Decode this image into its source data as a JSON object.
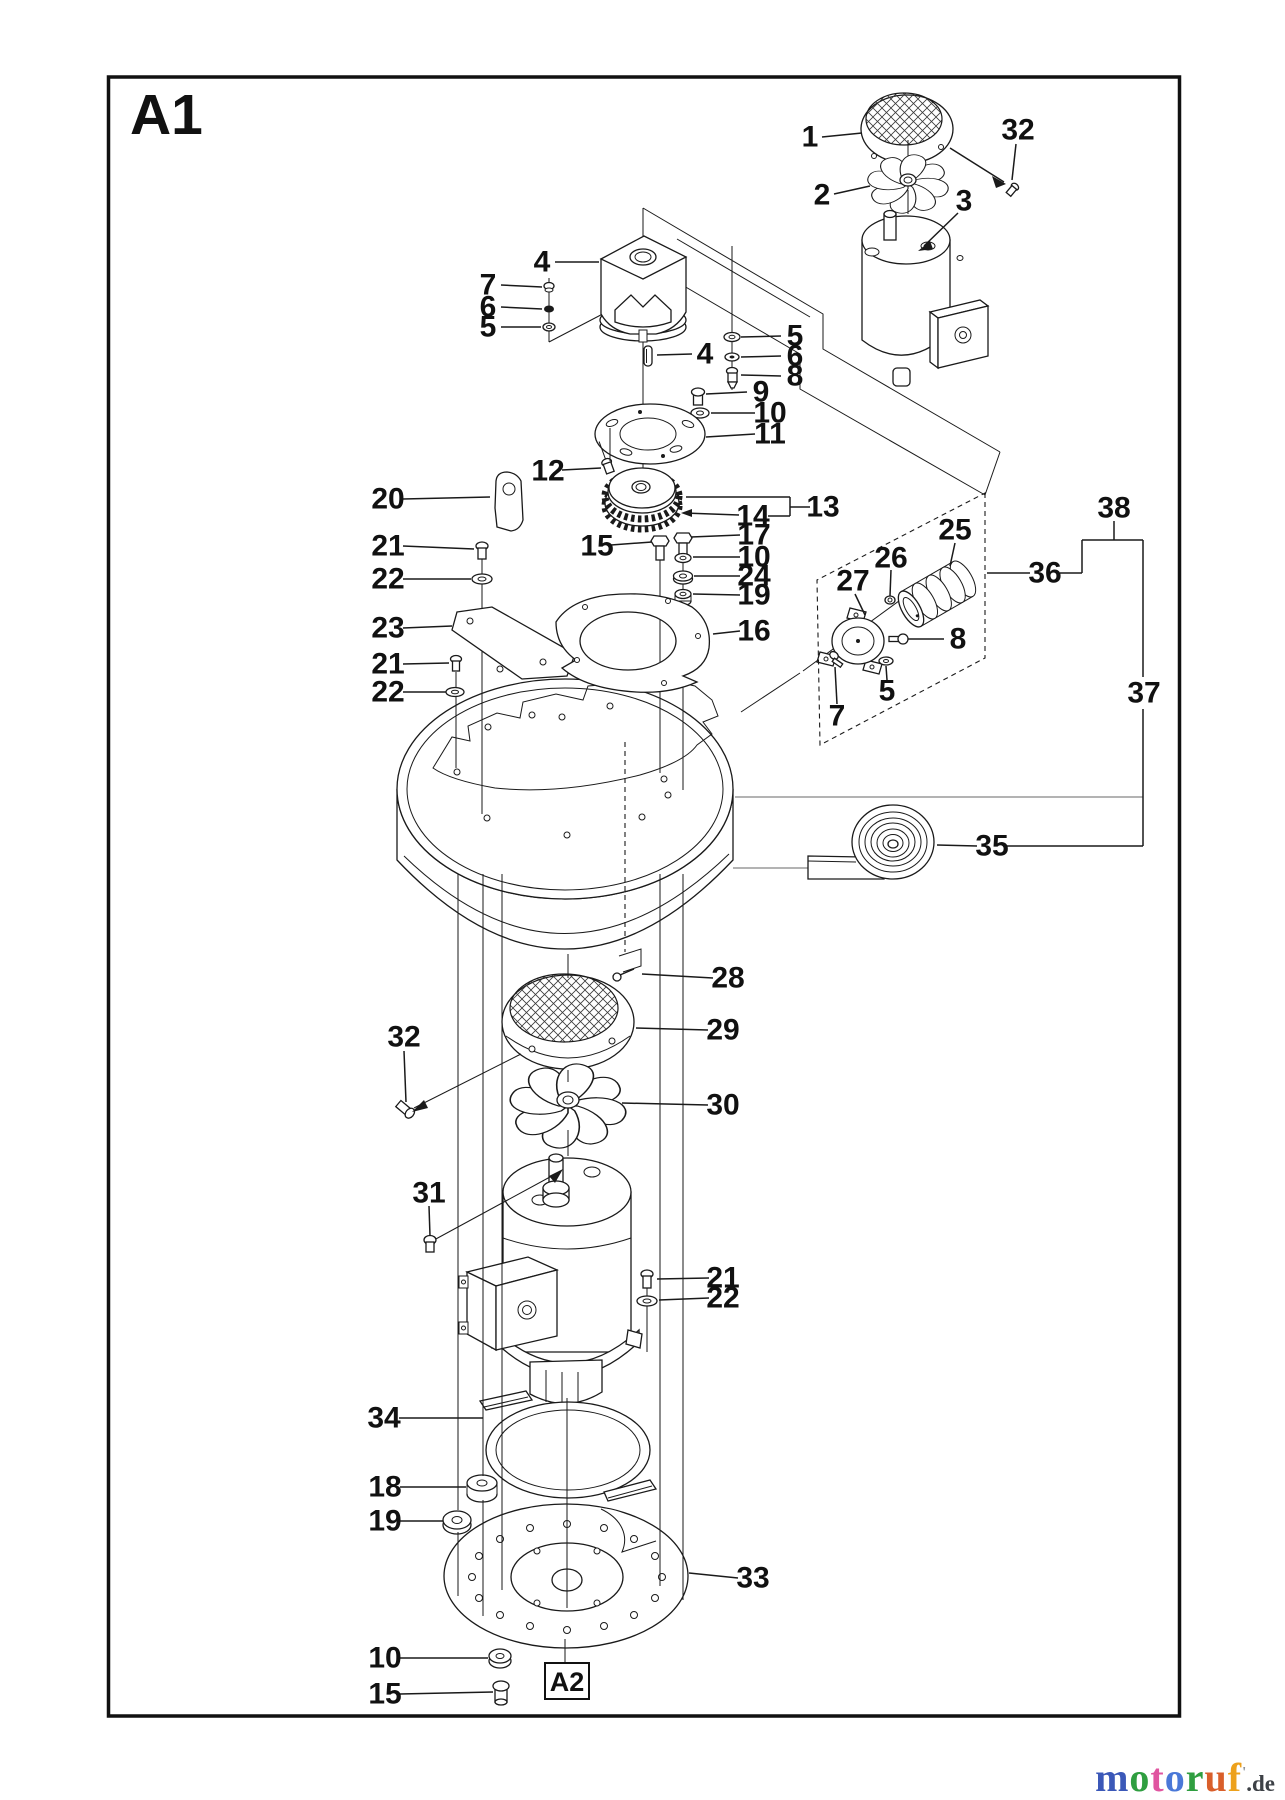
{
  "page": {
    "sheet_label": "A1",
    "detail_ref": "A2"
  },
  "branding": {
    "site": "motoruf",
    "tld": ".de",
    "tld_color": "#3d4146",
    "mark": "'",
    "mark_color": "#8a9096",
    "letters": [
      {
        "ch": "m",
        "color": "#3b58b8"
      },
      {
        "ch": "o",
        "color": "#2f9e40"
      },
      {
        "ch": "t",
        "color": "#e055a0"
      },
      {
        "ch": "o",
        "color": "#4a78d8"
      },
      {
        "ch": "r",
        "color": "#2f9e40"
      },
      {
        "ch": "u",
        "color": "#d95f2b"
      },
      {
        "ch": "f",
        "color": "#eda11c"
      }
    ]
  },
  "callouts": [
    {
      "n": "1",
      "x": 810,
      "y": 137,
      "segs": [
        [
          822,
          137,
          862,
          133
        ]
      ]
    },
    {
      "n": "32",
      "x": 1018,
      "y": 130,
      "segs": [
        [
          1016,
          144,
          1012,
          180
        ],
        [
          950,
          148,
          1004,
          182
        ]
      ]
    },
    {
      "n": "2",
      "x": 822,
      "y": 195,
      "segs": [
        [
          834,
          194,
          870,
          186
        ]
      ]
    },
    {
      "n": "3",
      "x": 964,
      "y": 201,
      "segs": [
        [
          958,
          213,
          924,
          246
        ]
      ]
    },
    {
      "n": "4",
      "x": 542,
      "y": 262,
      "segs": [
        [
          555,
          262,
          599,
          262
        ]
      ]
    },
    {
      "n": "7",
      "x": 488,
      "y": 285,
      "segs": [
        [
          501,
          285,
          542,
          287
        ]
      ]
    },
    {
      "n": "6",
      "x": 488,
      "y": 307,
      "segs": [
        [
          501,
          307,
          542,
          309
        ]
      ]
    },
    {
      "n": "5",
      "x": 488,
      "y": 327,
      "segs": [
        [
          501,
          327,
          541,
          327
        ]
      ]
    },
    {
      "n": "4",
      "x": 705,
      "y": 354,
      "segs": [
        [
          692,
          354,
          657,
          355
        ]
      ]
    },
    {
      "n": "5",
      "x": 795,
      "y": 336,
      "segs": [
        [
          781,
          336,
          741,
          337
        ]
      ]
    },
    {
      "n": "6",
      "x": 795,
      "y": 356,
      "segs": [
        [
          781,
          356,
          741,
          357
        ]
      ]
    },
    {
      "n": "8",
      "x": 795,
      "y": 376,
      "segs": [
        [
          781,
          376,
          741,
          375
        ]
      ]
    },
    {
      "n": "9",
      "x": 761,
      "y": 392,
      "segs": [
        [
          747,
          392,
          706,
          394
        ]
      ]
    },
    {
      "n": "10",
      "x": 770,
      "y": 413,
      "segs": [
        [
          755,
          413,
          711,
          413
        ]
      ]
    },
    {
      "n": "11",
      "x": 770,
      "y": 434,
      "segs": [
        [
          755,
          434,
          706,
          437
        ]
      ]
    },
    {
      "n": "12",
      "x": 548,
      "y": 471,
      "segs": [
        [
          562,
          470,
          601,
          468
        ]
      ]
    },
    {
      "n": "13",
      "x": 823,
      "y": 507,
      "segs": [
        [
          810,
          507,
          790,
          507
        ],
        [
          790,
          497,
          790,
          516
        ],
        [
          790,
          497,
          686,
          497
        ],
        [
          790,
          516,
          768,
          516
        ]
      ]
    },
    {
      "n": "14",
      "x": 753,
      "y": 516,
      "segs": [
        [
          739,
          515,
          684,
          513
        ]
      ]
    },
    {
      "n": "17",
      "x": 754,
      "y": 535,
      "segs": [
        [
          740,
          535,
          691,
          537
        ]
      ]
    },
    {
      "n": "10",
      "x": 754,
      "y": 557,
      "segs": [
        [
          740,
          557,
          693,
          557
        ]
      ]
    },
    {
      "n": "24",
      "x": 754,
      "y": 576,
      "segs": [
        [
          740,
          576,
          694,
          576
        ]
      ]
    },
    {
      "n": "19",
      "x": 754,
      "y": 595,
      "segs": [
        [
          740,
          595,
          693,
          594
        ]
      ]
    },
    {
      "n": "16",
      "x": 754,
      "y": 631,
      "segs": [
        [
          740,
          631,
          713,
          634
        ]
      ]
    },
    {
      "n": "20",
      "x": 388,
      "y": 499,
      "segs": [
        [
          403,
          499,
          490,
          497
        ]
      ]
    },
    {
      "n": "21",
      "x": 388,
      "y": 546,
      "segs": [
        [
          403,
          546,
          474,
          549
        ]
      ]
    },
    {
      "n": "22",
      "x": 388,
      "y": 579,
      "segs": [
        [
          403,
          579,
          471,
          579
        ]
      ]
    },
    {
      "n": "23",
      "x": 388,
      "y": 628,
      "segs": [
        [
          403,
          628,
          452,
          626
        ]
      ]
    },
    {
      "n": "21",
      "x": 388,
      "y": 664,
      "segs": [
        [
          403,
          664,
          449,
          663
        ]
      ]
    },
    {
      "n": "22",
      "x": 388,
      "y": 692,
      "segs": [
        [
          403,
          692,
          446,
          692
        ]
      ]
    },
    {
      "n": "15",
      "x": 597,
      "y": 546,
      "segs": [
        [
          611,
          545,
          652,
          542
        ]
      ]
    },
    {
      "n": "25",
      "x": 955,
      "y": 530,
      "segs": [
        [
          955,
          543,
          950,
          566
        ]
      ]
    },
    {
      "n": "26",
      "x": 891,
      "y": 558,
      "segs": [
        [
          891,
          570,
          890,
          596
        ]
      ]
    },
    {
      "n": "27",
      "x": 853,
      "y": 581,
      "segs": [
        [
          855,
          594,
          865,
          615
        ]
      ]
    },
    {
      "n": "8",
      "x": 958,
      "y": 639,
      "segs": [
        [
          944,
          639,
          908,
          639
        ]
      ]
    },
    {
      "n": "5",
      "x": 887,
      "y": 691,
      "segs": [
        [
          887,
          680,
          886,
          666
        ]
      ]
    },
    {
      "n": "7",
      "x": 837,
      "y": 716,
      "segs": [
        [
          837,
          704,
          835,
          667
        ]
      ]
    },
    {
      "n": "36",
      "x": 1045,
      "y": 573,
      "segs": [
        [
          1030,
          573,
          987,
          573
        ],
        [
          1060,
          573,
          1082,
          573
        ],
        [
          1082,
          573,
          1082,
          540
        ]
      ]
    },
    {
      "n": "38",
      "x": 1114,
      "y": 508,
      "segs": [
        [
          1114,
          521,
          1114,
          540
        ],
        [
          1082,
          540,
          1143,
          540
        ]
      ]
    },
    {
      "n": "37",
      "x": 1144,
      "y": 693,
      "segs": [
        [
          1143,
          540,
          1143,
          677
        ],
        [
          1143,
          709,
          1143,
          846
        ]
      ]
    },
    {
      "n": "35",
      "x": 992,
      "y": 846,
      "segs": [
        [
          977,
          846,
          937,
          845
        ],
        [
          1007,
          846,
          1143,
          846
        ]
      ]
    },
    {
      "n": "28",
      "x": 728,
      "y": 978,
      "segs": [
        [
          713,
          978,
          642,
          974
        ]
      ]
    },
    {
      "n": "29",
      "x": 723,
      "y": 1030,
      "segs": [
        [
          708,
          1030,
          636,
          1028
        ]
      ]
    },
    {
      "n": "30",
      "x": 723,
      "y": 1105,
      "segs": [
        [
          708,
          1105,
          622,
          1103
        ]
      ]
    },
    {
      "n": "32",
      "x": 404,
      "y": 1037,
      "segs": [
        [
          404,
          1051,
          406,
          1102
        ]
      ]
    },
    {
      "n": "31",
      "x": 429,
      "y": 1193,
      "segs": [
        [
          429,
          1206,
          430,
          1236
        ]
      ]
    },
    {
      "n": "21",
      "x": 723,
      "y": 1278,
      "segs": [
        [
          709,
          1278,
          657,
          1279
        ]
      ]
    },
    {
      "n": "22",
      "x": 723,
      "y": 1298,
      "segs": [
        [
          709,
          1298,
          659,
          1300
        ]
      ]
    },
    {
      "n": "34",
      "x": 384,
      "y": 1418,
      "segs": [
        [
          399,
          1418,
          483,
          1418
        ]
      ]
    },
    {
      "n": "18",
      "x": 385,
      "y": 1487,
      "segs": [
        [
          400,
          1487,
          466,
          1487
        ]
      ]
    },
    {
      "n": "19",
      "x": 385,
      "y": 1521,
      "segs": [
        [
          400,
          1521,
          443,
          1521
        ]
      ]
    },
    {
      "n": "33",
      "x": 753,
      "y": 1578,
      "segs": [
        [
          738,
          1578,
          689,
          1573
        ]
      ]
    },
    {
      "n": "10",
      "x": 385,
      "y": 1658,
      "segs": [
        [
          400,
          1658,
          488,
          1658
        ]
      ]
    },
    {
      "n": "15",
      "x": 385,
      "y": 1694,
      "segs": [
        [
          400,
          1694,
          493,
          1692
        ]
      ]
    }
  ]
}
